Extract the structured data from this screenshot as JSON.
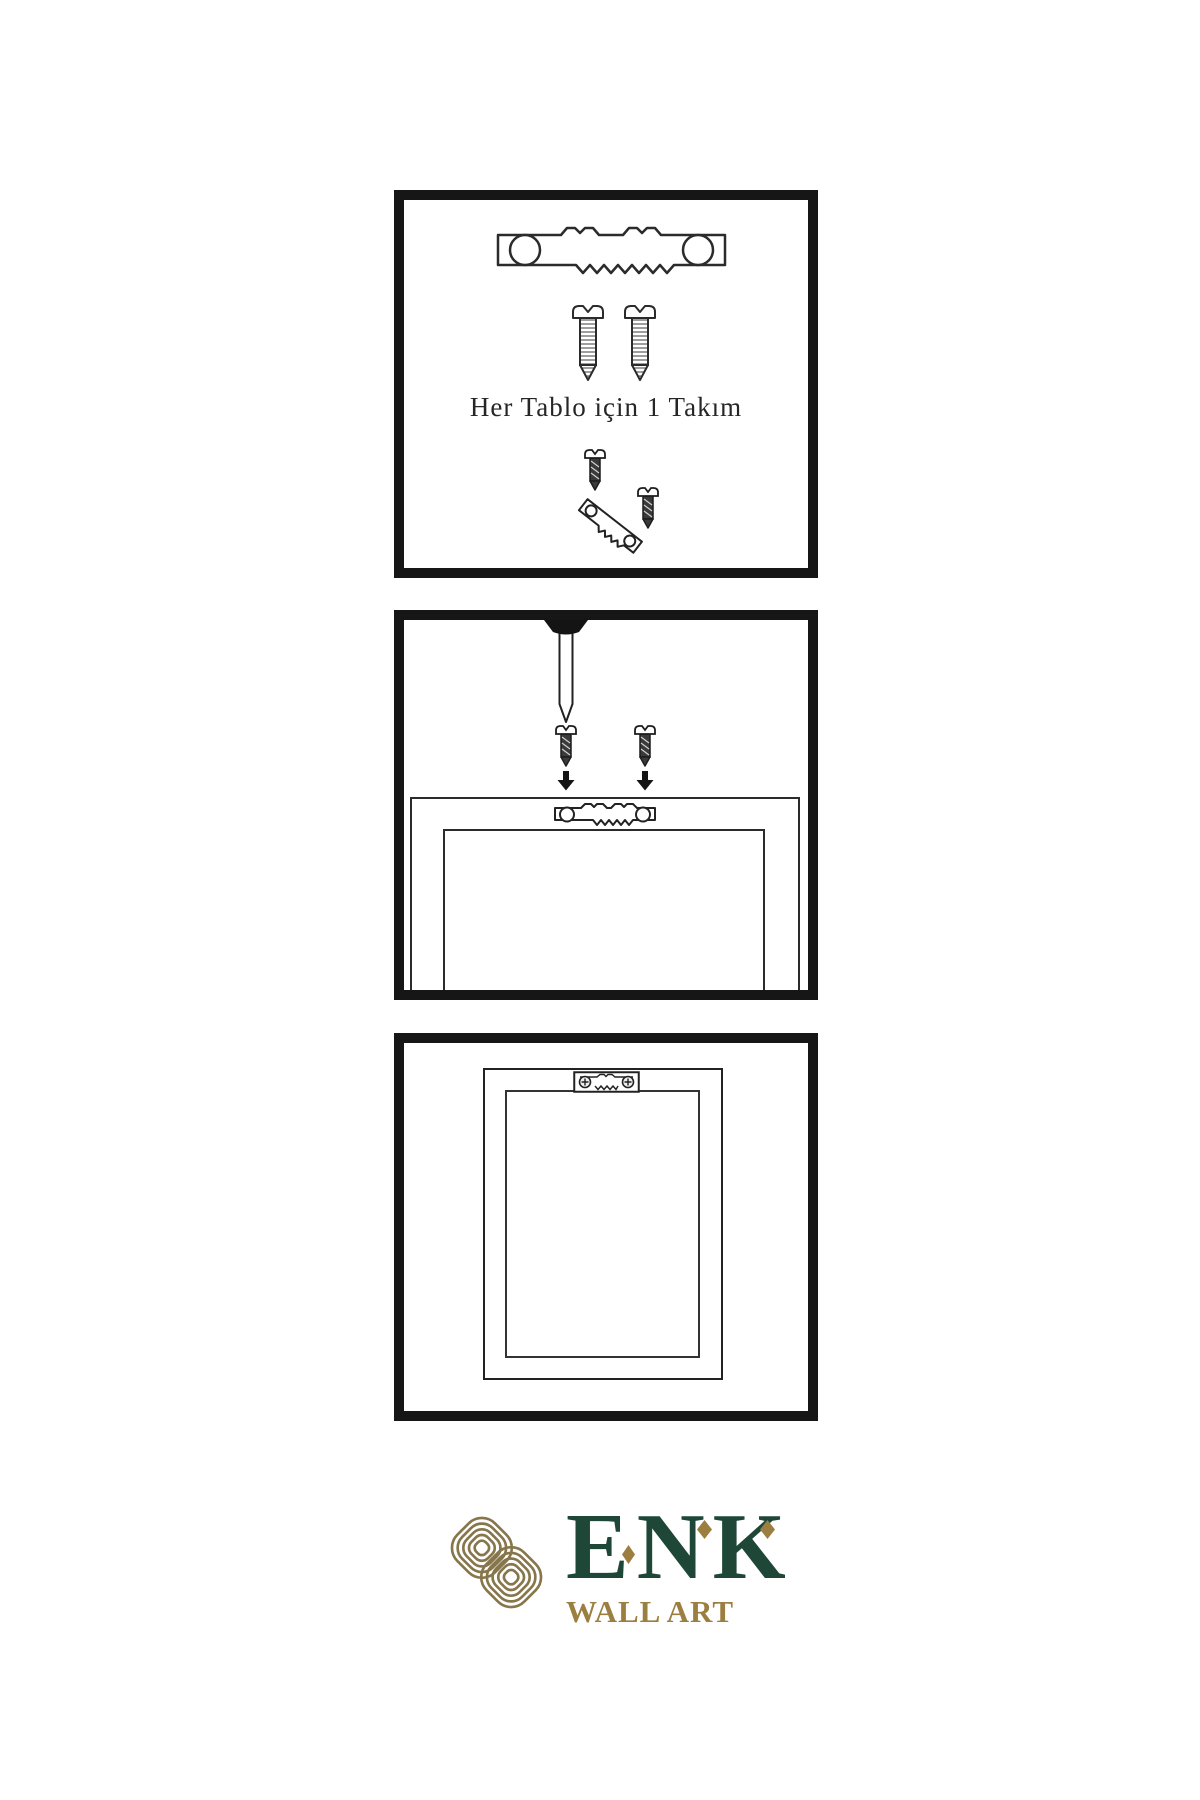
{
  "page": {
    "background": "#ffffff",
    "line_color": "#262626"
  },
  "kit_panel": {
    "caption": "Her Tablo için 1 Takım",
    "items": [
      "sawtooth-hanger",
      "screw",
      "screw",
      "angled-hanger-with-screws"
    ]
  },
  "install_panel": {
    "items": [
      "wall-nail",
      "screw-with-down-arrow",
      "screw-with-down-arrow",
      "frame-back-with-mounted-hanger"
    ]
  },
  "result_panel": {
    "items": [
      "hung-frame-with-installed-hanger"
    ]
  },
  "logo": {
    "letters": [
      "E",
      "N",
      "K"
    ],
    "subtitle": "WALL ART",
    "icon_name": "interlaced-knot",
    "green": "#1E4738",
    "gold": "#9C7F40",
    "icon_gold": "#87764B"
  }
}
